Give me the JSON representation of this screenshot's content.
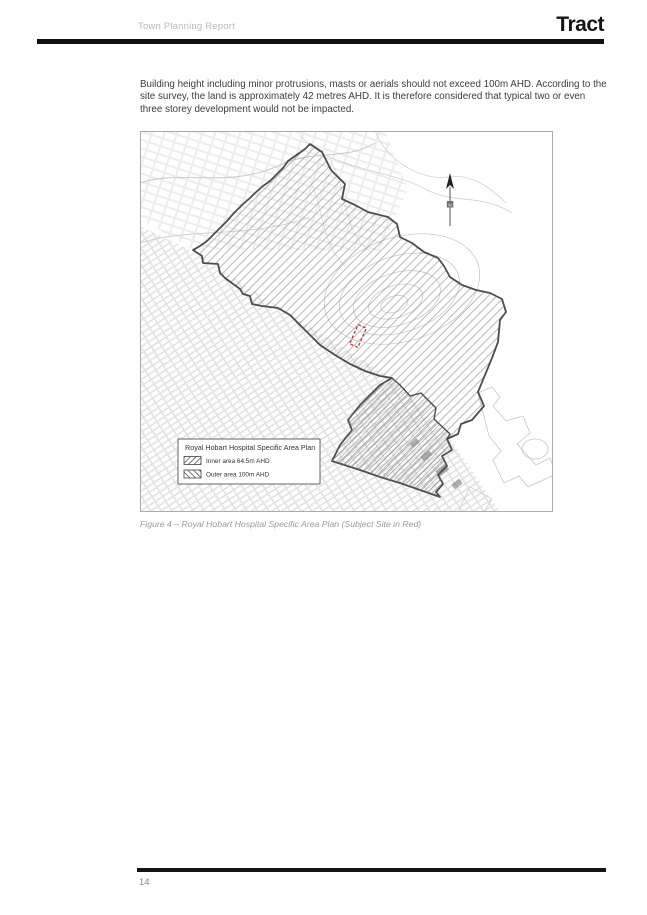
{
  "header": {
    "report_title": "Town Planning Report",
    "brand": "Tract"
  },
  "body": {
    "paragraph": "Building height including minor protrusions, masts or aerials should not exceed 100m AHD. According to the site survey, the land is approximately 42 metres AHD. It is therefore considered that typical two or even three storey development would not be impacted."
  },
  "figure": {
    "caption": "Figure 4 – Royal Hobart Hospital Specific Area Plan (Subject Site in Red)",
    "north_label": "N",
    "legend": {
      "title": "Royal Hobart Hospital Specific Area Plan",
      "items": [
        {
          "label": "Inner area  64.5m AHD",
          "hatch": "forward-slash"
        },
        {
          "label": "Outer area  100m AHD",
          "hatch": "back-slash"
        }
      ]
    },
    "colors": {
      "boundary": "#4d4d4d",
      "hatch": "#9a9a9a",
      "subject_site": "#cc2b2b",
      "fabric": "#cdcdcd"
    },
    "map": {
      "outer_boundary": [
        [
          53,
          119
        ],
        [
          60,
          115
        ],
        [
          67,
          110
        ],
        [
          77,
          100
        ],
        [
          87,
          90
        ],
        [
          93,
          83
        ],
        [
          103,
          73
        ],
        [
          110,
          67
        ],
        [
          115,
          62
        ],
        [
          123,
          55
        ],
        [
          130,
          50
        ],
        [
          143,
          37
        ],
        [
          148,
          30
        ],
        [
          165,
          18
        ],
        [
          170,
          13
        ],
        [
          182,
          21
        ],
        [
          191,
          39
        ],
        [
          205,
          53
        ],
        [
          202,
          68
        ],
        [
          215,
          74
        ],
        [
          228,
          81
        ],
        [
          248,
          86
        ],
        [
          257,
          93
        ],
        [
          260,
          106
        ],
        [
          272,
          112
        ],
        [
          284,
          121
        ],
        [
          298,
          127
        ],
        [
          304,
          135
        ],
        [
          310,
          146
        ],
        [
          322,
          154
        ],
        [
          336,
          159
        ],
        [
          350,
          162
        ],
        [
          362,
          168
        ],
        [
          366,
          181
        ],
        [
          360,
          189
        ],
        [
          358,
          211
        ],
        [
          352,
          227
        ],
        [
          338,
          261
        ],
        [
          344,
          275
        ],
        [
          332,
          289
        ],
        [
          321,
          293
        ],
        [
          318,
          303
        ],
        [
          307,
          308
        ],
        [
          312,
          319
        ],
        [
          302,
          325
        ],
        [
          307,
          335
        ],
        [
          298,
          344
        ],
        [
          303,
          353
        ],
        [
          296,
          361
        ],
        [
          300,
          366
        ],
        [
          280,
          359
        ],
        [
          260,
          352
        ],
        [
          240,
          346
        ],
        [
          220,
          339
        ],
        [
          192,
          330
        ],
        [
          200,
          314
        ],
        [
          212,
          299
        ],
        [
          208,
          289
        ],
        [
          220,
          274
        ],
        [
          230,
          264
        ],
        [
          240,
          254
        ],
        [
          252,
          247
        ],
        [
          240,
          245
        ],
        [
          225,
          240
        ],
        [
          210,
          233
        ],
        [
          195,
          224
        ],
        [
          180,
          214
        ],
        [
          170,
          204
        ],
        [
          160,
          194
        ],
        [
          150,
          184
        ],
        [
          138,
          177
        ],
        [
          122,
          175
        ],
        [
          112,
          173
        ],
        [
          110,
          165
        ],
        [
          103,
          163
        ],
        [
          100,
          158
        ],
        [
          85,
          147
        ],
        [
          80,
          142
        ],
        [
          78,
          133
        ],
        [
          63,
          132
        ],
        [
          62,
          125
        ]
      ],
      "divider": [
        [
          252,
          247
        ],
        [
          260,
          254
        ],
        [
          270,
          265
        ],
        [
          281,
          262
        ],
        [
          296,
          277
        ],
        [
          294,
          288
        ],
        [
          310,
          303
        ],
        [
          307,
          308
        ]
      ],
      "inner_band": [
        [
          252,
          247
        ],
        [
          260,
          254
        ],
        [
          270,
          265
        ],
        [
          281,
          262
        ],
        [
          296,
          277
        ],
        [
          294,
          288
        ],
        [
          310,
          303
        ],
        [
          307,
          308
        ],
        [
          312,
          319
        ],
        [
          302,
          325
        ],
        [
          307,
          335
        ],
        [
          298,
          344
        ],
        [
          303,
          353
        ],
        [
          296,
          361
        ],
        [
          300,
          366
        ],
        [
          280,
          359
        ],
        [
          260,
          352
        ],
        [
          240,
          346
        ],
        [
          220,
          339
        ],
        [
          192,
          330
        ],
        [
          200,
          314
        ],
        [
          212,
          299
        ],
        [
          208,
          289
        ],
        [
          220,
          274
        ],
        [
          230,
          264
        ],
        [
          240,
          254
        ]
      ],
      "subject_site": {
        "cx": 218,
        "cy": 205,
        "w": 9,
        "h": 21,
        "rotate": 24
      }
    }
  },
  "footer": {
    "page_number": "14"
  }
}
